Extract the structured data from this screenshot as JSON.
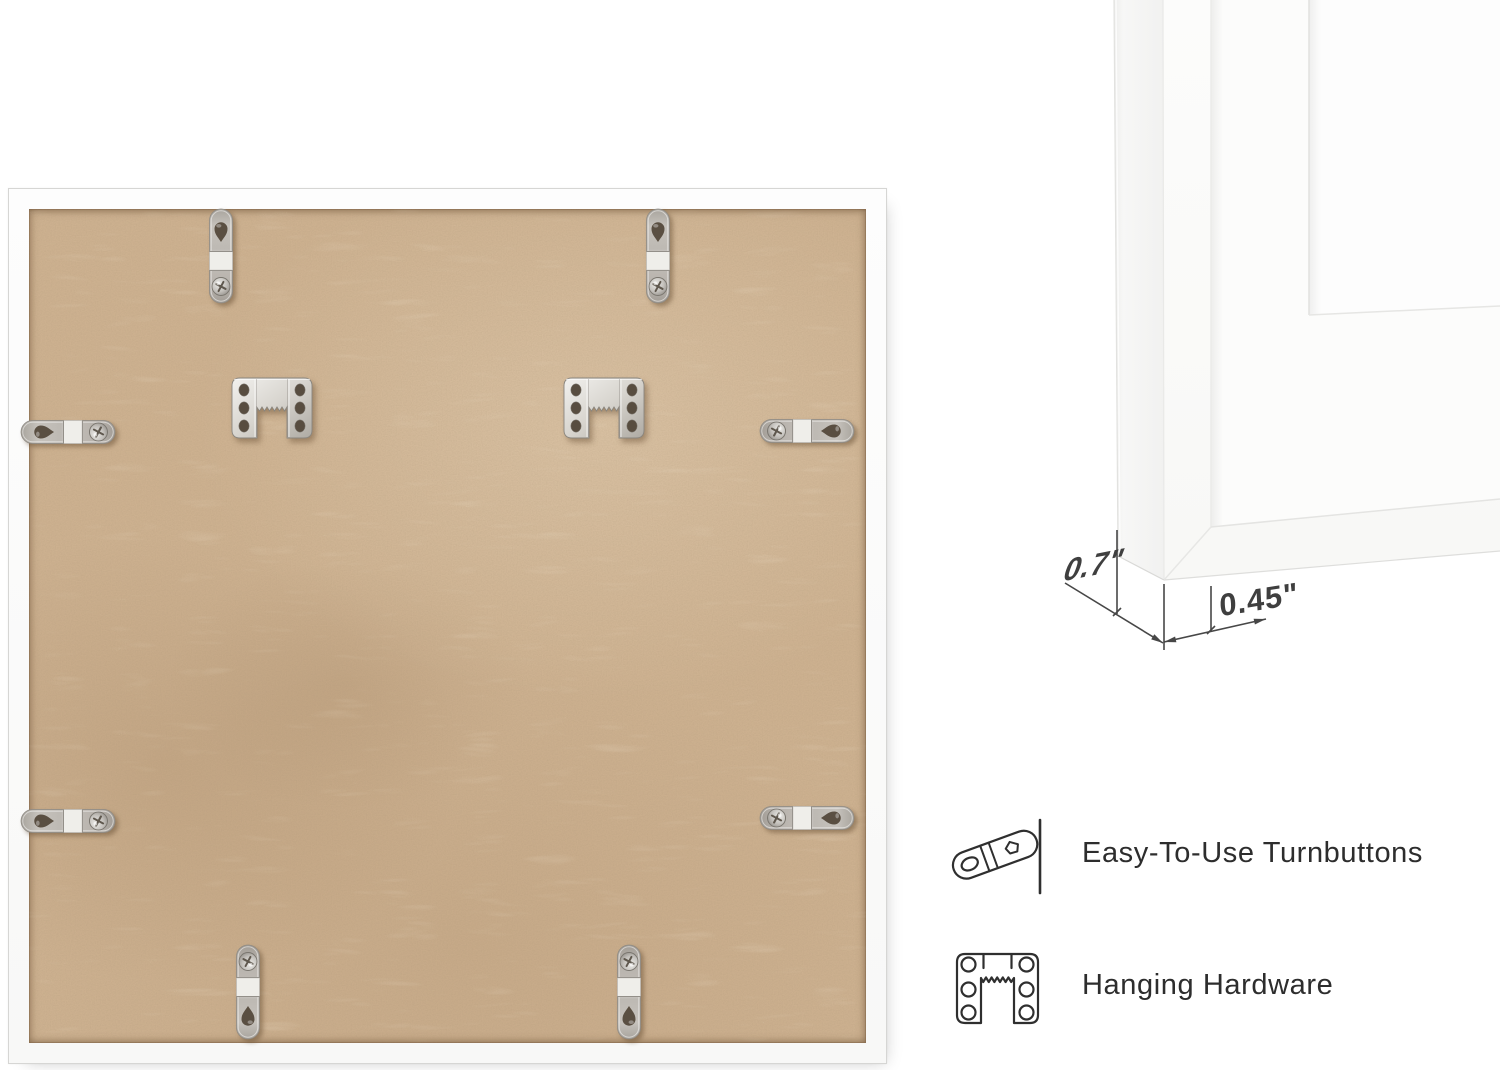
{
  "canvas": {
    "width": 1500,
    "height": 1070,
    "background": "#ffffff"
  },
  "photo": {
    "subject": "back of square white picture frame with MDF backing",
    "turnbutton_count": 8,
    "sawtooth_hanger_count": 2,
    "colors": {
      "mdf": "#cdb190",
      "frame_white": "#fcfcfb",
      "metal": "#c9c5bf"
    }
  },
  "corner_closeup": {
    "depth_label": "0.7\"",
    "face_label": "0.45\""
  },
  "features": [
    {
      "icon": "turnbutton-icon",
      "label": "Easy-To-Use Turnbuttons"
    },
    {
      "icon": "hanging-hardware-icon",
      "label": "Hanging Hardware"
    }
  ],
  "styles": {
    "label_color": "#2d2d2d",
    "dimension_color": "#3f3f3f",
    "icon_stroke": "#2f2f2f"
  }
}
